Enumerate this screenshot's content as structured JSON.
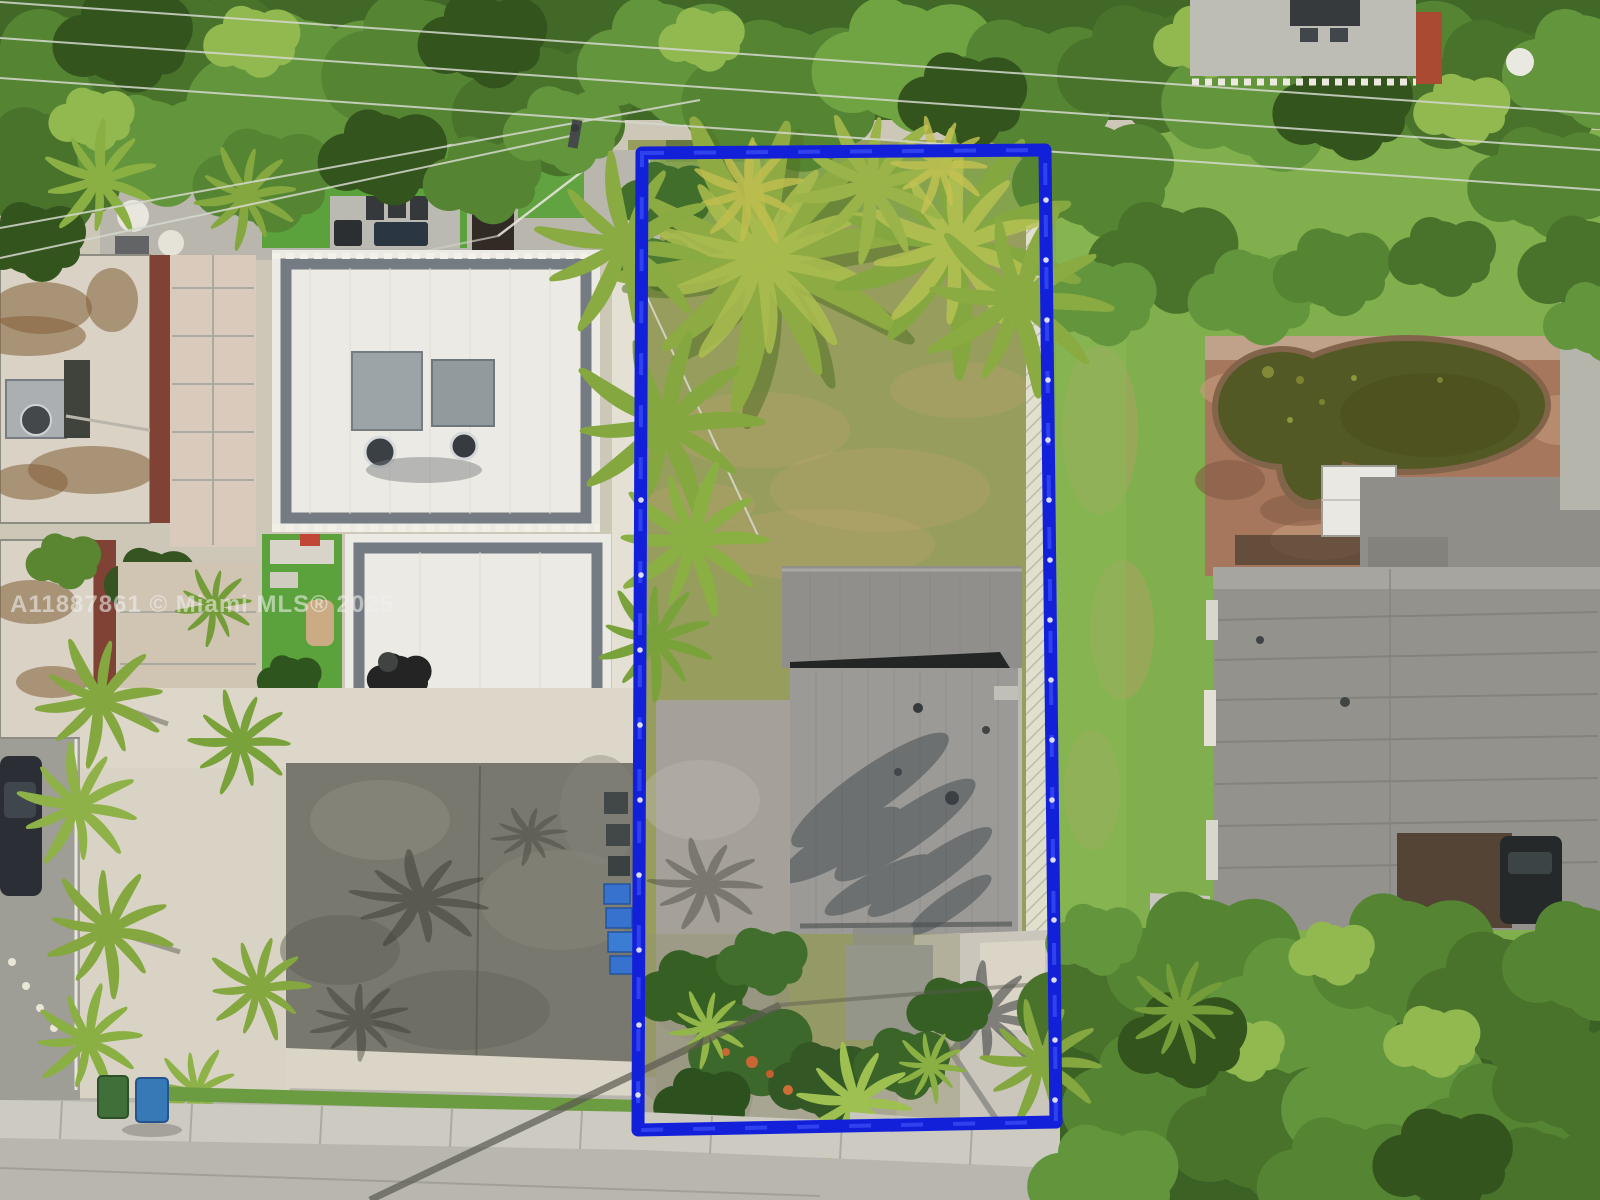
{
  "photo": {
    "type": "aerial-drone-photo",
    "subject": "residential lot outlined with blue property boundary, Miami neighborhood"
  },
  "watermark": {
    "text": "A11887861 © Miami MLS® 2025",
    "listing_id": "A11887861",
    "mls_name": "Miami MLS",
    "year": "2025",
    "color": "#f0f0ee"
  },
  "boundary": {
    "color": "#0a18dc",
    "highlight_color": "#3c55ff",
    "shape": "rectangle",
    "stroke_px": 13
  },
  "palette": {
    "canopy_base": "#3a6322",
    "canopy_dark": "#2c4f17",
    "lot_lawn": "#939c5a",
    "neighbor_lawn": "#7cad49",
    "turf": "#55a038",
    "asphalt": "#74746c",
    "street": "#b6b5af",
    "sidewalk": "#cac9c2",
    "gravel": "#dad5c8",
    "white_roof": "#ecebe7",
    "gray_roof": "#979795",
    "dark_roof": "#8f8f8b",
    "brick": "#a3735a",
    "pond": "#4d5420",
    "left_roof": "#d8d2c6"
  }
}
